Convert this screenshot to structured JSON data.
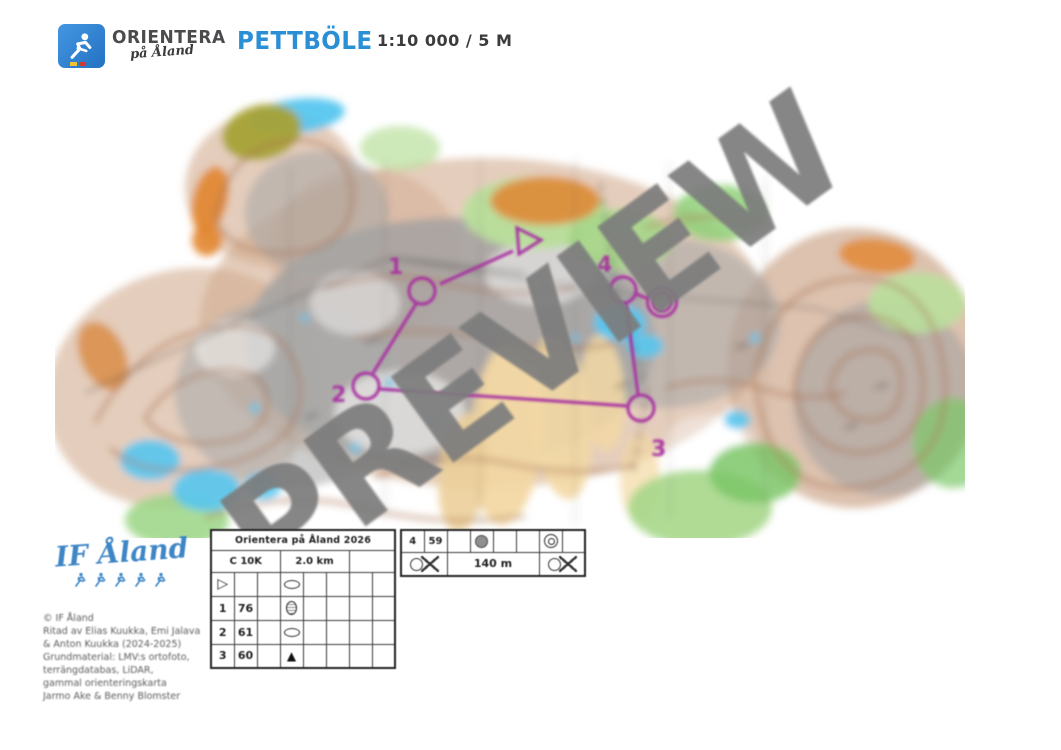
{
  "header": {
    "org_name": "ORIENTERA",
    "org_sub": "på Åland",
    "title": "PETTBÖLE",
    "scale": "1:10 000 / 5 M"
  },
  "map": {
    "watermark": "PREVIEW",
    "course_labels": {
      "c1": "1",
      "c2": "2",
      "c3": "3",
      "c4": "4"
    }
  },
  "club": {
    "name": "IF Åland",
    "credits": [
      "© IF Åland",
      "Ritad av Elias Kuukka, Emi Jalava",
      "& Anton Kuukka (2024-2025)",
      "Grundmaterial: LMV:s ortofoto,",
      "terrängdatabas, LiDAR,",
      "gammal orienteringskarta",
      "Jarmo Ake & Benny Blomster"
    ]
  },
  "control_card": {
    "title": "Orientera på Åland 2026",
    "course_class": "C 10K",
    "length": "2.0 km",
    "rows": [
      {
        "a": "",
        "b": "",
        "a_sym": "start",
        "d_sym": "ellipse"
      },
      {
        "a": "1",
        "b": "76",
        "a_sym": "",
        "d_sym": "hatched-circle"
      },
      {
        "a": "2",
        "b": "61",
        "a_sym": "",
        "d_sym": "ellipse"
      },
      {
        "a": "3",
        "b": "60",
        "a_sym": "",
        "d_sym": "boulder"
      }
    ],
    "right_row": {
      "a": "4",
      "b": "59",
      "d_sym": "gray-disc",
      "g_sym": "double-circle"
    },
    "finish_row": {
      "left_sym": "finish-x",
      "distance": "140 m",
      "right_sym": "finish-x"
    }
  },
  "colors": {
    "accent_blue": "#2b8fd6",
    "club_blue": "#3f86c6",
    "watermark_gray": "#7c7c7c",
    "course_purple": "#a832a0"
  }
}
